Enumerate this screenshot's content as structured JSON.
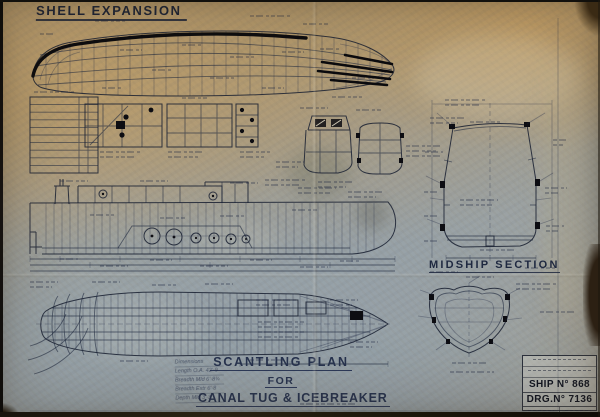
{
  "colors": {
    "ink": "#1c2334",
    "heavy_line": "#0b0b0e",
    "paper_tan": "#b49c74",
    "paper_grey": "#95a1a8"
  },
  "titles": {
    "shell_expansion": "SHELL EXPANSION",
    "midship_section": "MIDSHIP SECTION"
  },
  "main_title": {
    "line1": "SCANTLING PLAN",
    "line2": "FOR",
    "line3": "CANAL TUG & ICEBREAKER",
    "scale_note": "Scale ¾″ = 1 Foot"
  },
  "dimensions_note": {
    "lines": [
      "Dimensions",
      "Length O.A. 42'·9",
      "Breadth Mld 6'·8¾",
      "Breadth Extr 6'·8",
      "Depth Mld 3'·3"
    ]
  },
  "title_block": {
    "ship_no": "SHIP N° 868",
    "drg_no": "DRG.N° 7136"
  }
}
